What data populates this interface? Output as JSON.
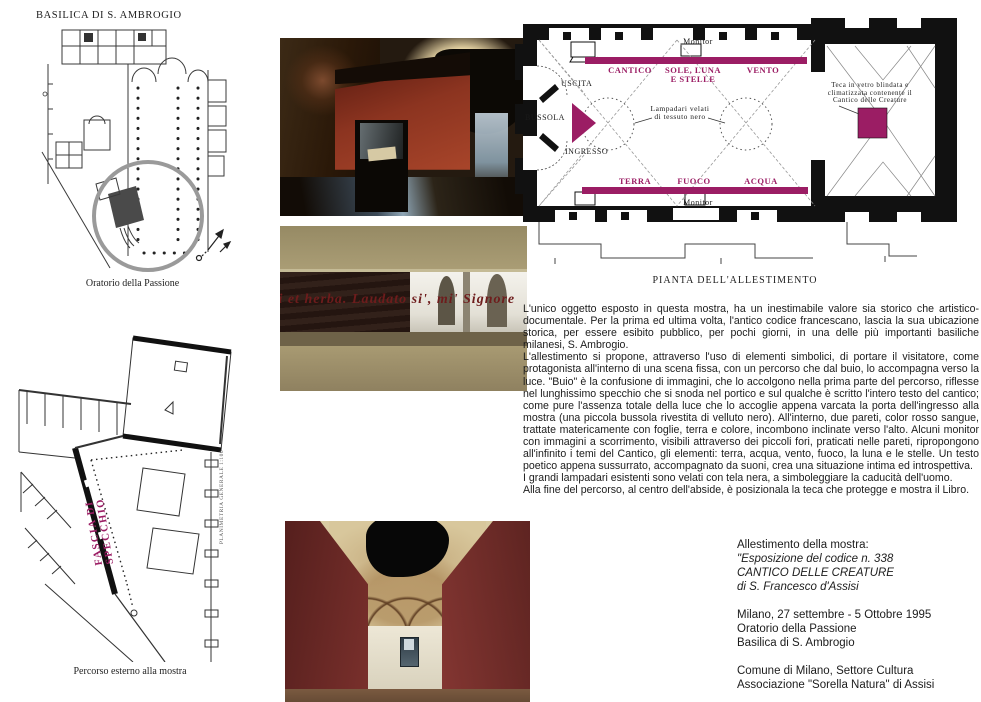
{
  "accent": "#9b1d64",
  "basilica_plan": {
    "title": "BASILICA DI S. AMBROGIO",
    "caption": "Oratorio della Passione"
  },
  "percorso_plan": {
    "caption": "Percorso esterno alla mostra",
    "mirror_band_label": "FASCIA DI SPECCHIO",
    "side_note": "PLANIMETRIA GENERALE 1:100"
  },
  "photos": {
    "mirror_text": "ri et herba.  Laudato si', mi' Signore"
  },
  "allestimento_plan": {
    "caption": "PIANTA DELL'ALLESTIMENTO",
    "labels": {
      "monitor_top": "Monitor",
      "cantico": "CANTICO",
      "sole_luna_stelle": "SOLE, LUNA E STELLE",
      "vento": "VENTO",
      "uscita": "USCITA",
      "bussola": "BUSSOLA",
      "ingresso": "INGRESSO",
      "lampadari": "Lampadari velati di tessuto nero",
      "teca": "Teca in vetro blindata e climatizzata contenente il Cantico delle Creature",
      "terra": "TERRA",
      "fuoco": "FUOCO",
      "acqua": "ACQUA",
      "monitor_bottom": "Monitor"
    }
  },
  "description": {
    "paragraphs": [
      "L'unico oggetto esposto in questa mostra, ha un inestimabile valore sia storico che artistico-documentale. Per la prima ed ultima volta, l'antico codice francescano, lascia la sua ubicazione storica, per essere esibito pubblico, per pochi giorni,  in una delle più importanti basiliche milanesi, S. Ambrogio.",
      "L'allestimento si propone, attraverso l'uso di elementi simbolici, di portare il visitatore, come protagonista all'interno di una scena fissa, con un percorso che dal buio, lo accompagna verso la luce. \"Buio\" è la confusione di immagini, che lo accolgono nella prima parte del percorso, riflesse nel lunghissimo specchio che si snoda  nel portico e  sul qualche è scritto l'intero testo del cantico; come pure l'assenza totale della luce che lo accoglie appena varcata la porta dell'ingresso alla mostra (una piccola bussola rivestita di velluto nero).  All'interno, due pareti, color rosso sangue, trattate matericamente con foglie, terra e colore, incombono inclinate verso l'alto. Alcuni monitor con immagini a scorrimento, visibili attraverso dei piccoli fori, praticati nelle pareti, ripropongono all'infinito i temi del Cantico, gli elementi: terra, acqua, vento, fuoco, la luna e le stelle. Un testo poetico appena sussurrato, accompagnato da suoni, crea una situazione intima ed introspettiva.",
      "I grandi lampadari esistenti sono velati con tela nera, a simboleggiare la caducità dell'uomo.",
      "Alla fine del percorso, al centro dell'abside, è posizionala la teca che protegge e mostra il Libro."
    ]
  },
  "credits": {
    "heading": "Allestimento della mostra:",
    "exhibition": [
      "\"Esposizione del codice n. 338",
      "CANTICO DELLE CREATURE",
      "di S. Francesco d'Assisi"
    ],
    "event": [
      "Milano, 27 settembre - 5 Ottobre 1995",
      "Oratorio della Passione",
      "Basilica di S. Ambrogio"
    ],
    "organizers": [
      "Comune di Milano, Settore Cultura",
      "Associazione \"Sorella Natura\" di Assisi"
    ]
  }
}
